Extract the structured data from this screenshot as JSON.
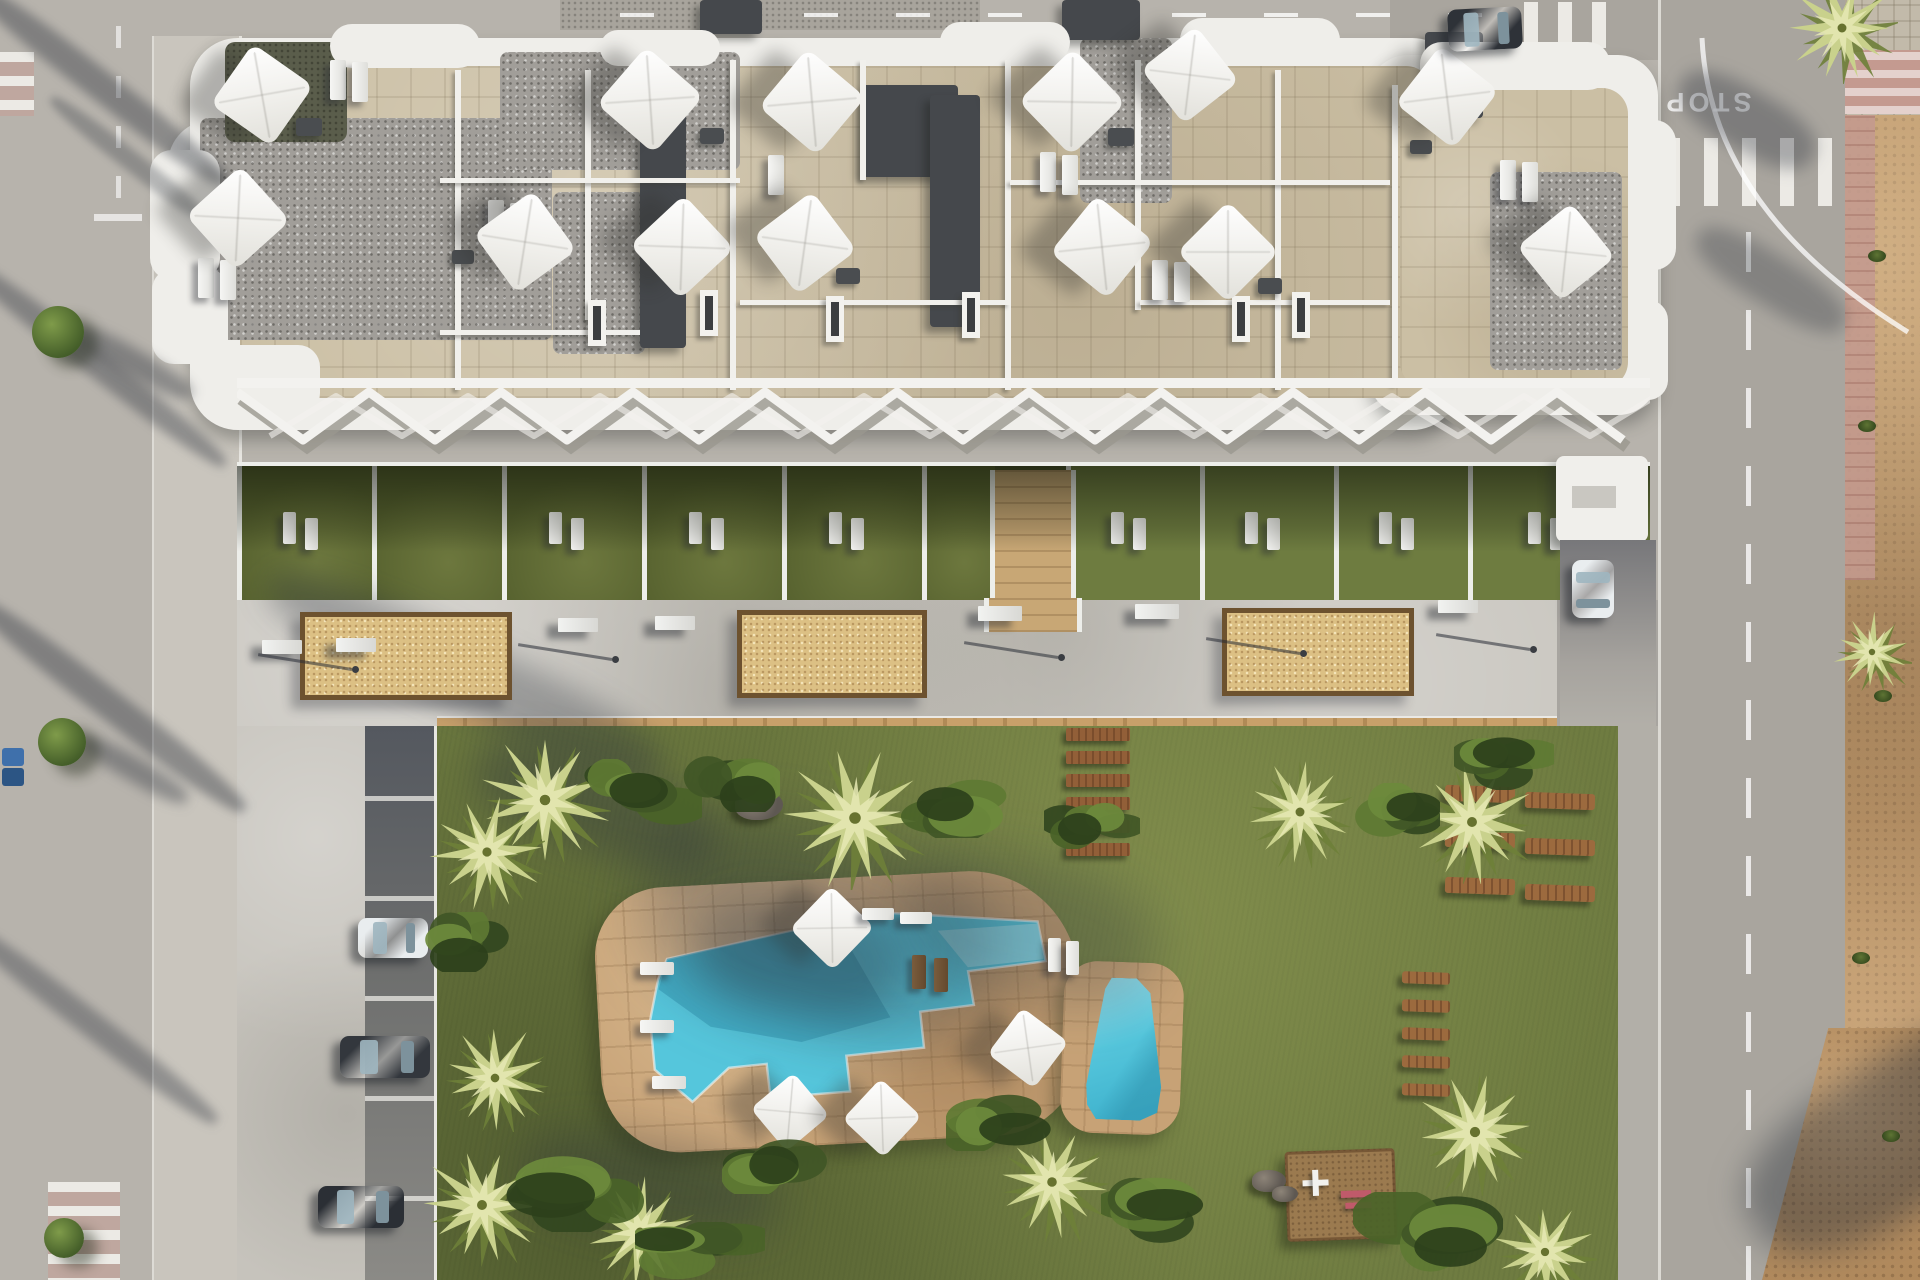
{
  "title": "aerial-render-residential-complex-with-pool",
  "road_markings": {
    "stop_text": "STOP"
  },
  "palette": {
    "road": "#b7b3ac",
    "road_right": "#a9a59e",
    "sidewalk": "#c9c5bd",
    "concrete": "#c6c3bc",
    "building_white": "#efeeea",
    "terrace_stone": "#cbbfa4",
    "gravel": "#a19e99",
    "dark_roof": "#45484c",
    "grass": "#6f7c41",
    "pool_deck_tan": "#c7a276",
    "water": "#55c6dc",
    "water_light": "#8fdcea",
    "planter_sand": "#dcc084",
    "planter_edge": "#6d522f",
    "dirt": "#b18a5d",
    "paver_pink": "#c49a90",
    "stripe_white": "#eceae5",
    "car_dark": "#2e3238",
    "car_white": "#e9edef"
  },
  "scene": {
    "roof_gravel": [
      [
        200,
        118,
        352,
        222
      ],
      [
        500,
        52,
        240,
        118
      ],
      [
        553,
        192,
        92,
        162
      ],
      [
        1080,
        38,
        92,
        165
      ],
      [
        1490,
        172,
        132,
        198
      ]
    ],
    "roof_dark": [
      [
        640,
        82,
        46,
        266
      ],
      [
        862,
        85,
        96,
        92
      ],
      [
        930,
        95,
        50,
        232
      ],
      [
        700,
        0,
        62,
        34
      ],
      [
        1062,
        0,
        78,
        40
      ],
      [
        1425,
        32,
        58,
        86
      ]
    ],
    "roof_olive": [
      [
        225,
        42,
        122,
        100
      ]
    ],
    "roof_bumps": [
      [
        330,
        24,
        150,
        44
      ],
      [
        600,
        30,
        120,
        36
      ],
      [
        940,
        22,
        130,
        40
      ],
      [
        1180,
        18,
        160,
        44
      ],
      [
        1420,
        42,
        190,
        48
      ],
      [
        150,
        150,
        70,
        130
      ],
      [
        152,
        268,
        76,
        96
      ],
      [
        1630,
        120,
        46,
        150
      ],
      [
        1628,
        300,
        40,
        100
      ],
      [
        210,
        345,
        110,
        70
      ]
    ],
    "walls_v": [
      [
        455,
        70,
        6,
        320
      ],
      [
        585,
        70,
        6,
        250
      ],
      [
        730,
        60,
        6,
        330
      ],
      [
        860,
        60,
        6,
        120
      ],
      [
        1005,
        60,
        6,
        330
      ],
      [
        1135,
        60,
        6,
        250
      ],
      [
        1275,
        70,
        6,
        320
      ],
      [
        1392,
        85,
        6,
        300
      ]
    ],
    "walls_h": [
      [
        440,
        178,
        300,
        5
      ],
      [
        740,
        300,
        270,
        5
      ],
      [
        1010,
        180,
        380,
        5
      ],
      [
        440,
        330,
        200,
        5
      ],
      [
        1140,
        300,
        250,
        5
      ]
    ],
    "skylights": [
      [
        700,
        290
      ],
      [
        826,
        296
      ],
      [
        962,
        292
      ],
      [
        1232,
        296
      ],
      [
        1292,
        292
      ],
      [
        588,
        300
      ]
    ],
    "roof_furniture": [
      [
        296,
        118,
        26,
        18
      ],
      [
        700,
        128,
        24,
        16
      ],
      [
        836,
        268,
        24,
        16
      ],
      [
        1108,
        128,
        26,
        18
      ],
      [
        1258,
        278,
        24,
        16
      ],
      [
        452,
        250,
        22,
        14
      ],
      [
        1410,
        140,
        22,
        14
      ]
    ],
    "roof_loungers": [
      [
        198,
        258
      ],
      [
        220,
        260
      ],
      [
        488,
        200
      ],
      [
        510,
        203
      ],
      [
        768,
        155
      ],
      [
        1040,
        152
      ],
      [
        1062,
        155
      ],
      [
        1152,
        260
      ],
      [
        1174,
        262
      ],
      [
        330,
        60
      ],
      [
        352,
        62
      ],
      [
        1500,
        160
      ],
      [
        1522,
        162
      ]
    ],
    "parasols": [
      [
        262,
        95,
        74
      ],
      [
        238,
        218,
        74
      ],
      [
        650,
        100,
        76
      ],
      [
        525,
        242,
        74
      ],
      [
        682,
        247,
        74
      ],
      [
        812,
        102,
        76
      ],
      [
        805,
        243,
        74
      ],
      [
        1072,
        102,
        76
      ],
      [
        1102,
        247,
        74
      ],
      [
        1190,
        75,
        70
      ],
      [
        1228,
        252,
        72
      ],
      [
        1447,
        97,
        74
      ],
      [
        1566,
        252,
        70
      ],
      [
        832,
        928,
        60
      ],
      [
        1028,
        1048,
        58
      ],
      [
        790,
        1112,
        56
      ],
      [
        882,
        1118,
        56
      ]
    ],
    "garden_cells": [
      {
        "x": 237,
        "w": 135,
        "lit": false,
        "loungers": true
      },
      {
        "x": 372,
        "w": 130,
        "lit": false,
        "loungers": false
      },
      {
        "x": 502,
        "w": 140,
        "lit": false,
        "loungers": true
      },
      {
        "x": 642,
        "w": 140,
        "lit": false,
        "loungers": true
      },
      {
        "x": 782,
        "w": 140,
        "lit": false,
        "loungers": true
      },
      {
        "x": 922,
        "w": 68,
        "lit": false,
        "loungers": false
      },
      {
        "x": 1066,
        "w": 134,
        "lit": true,
        "loungers": true
      },
      {
        "x": 1200,
        "w": 134,
        "lit": true,
        "loungers": true
      },
      {
        "x": 1334,
        "w": 134,
        "lit": true,
        "loungers": true
      },
      {
        "x": 1468,
        "w": 182,
        "lit": true,
        "loungers": true
      }
    ],
    "stone_path": {
      "x": 990,
      "y": 466,
      "w": 76,
      "h": 130
    },
    "planters": [
      [
        300,
        612,
        212,
        88
      ],
      [
        737,
        610,
        190,
        88
      ],
      [
        1222,
        608,
        192,
        88
      ]
    ],
    "benches": [
      [
        262,
        640,
        40,
        14
      ],
      [
        336,
        638,
        40,
        14
      ],
      [
        558,
        618,
        40,
        14
      ],
      [
        655,
        616,
        40,
        14
      ],
      [
        978,
        606,
        44,
        15
      ],
      [
        1135,
        604,
        44,
        15
      ],
      [
        1438,
        600,
        40,
        13
      ]
    ],
    "deck_lamps": [
      [
        352,
        668
      ],
      [
        612,
        658
      ],
      [
        1058,
        656
      ],
      [
        1300,
        652
      ],
      [
        1530,
        648
      ]
    ],
    "stall_lines_y": [
      796,
      896,
      996,
      1096,
      1196
    ],
    "planks_y": [
      728,
      751,
      774,
      797,
      820,
      843
    ],
    "wood_loungers": [
      [
        1445,
        786,
        70,
        16
      ],
      [
        1445,
        832,
        70,
        16
      ],
      [
        1445,
        878,
        70,
        16
      ],
      [
        1525,
        793,
        70,
        16
      ],
      [
        1525,
        839,
        70,
        16
      ],
      [
        1525,
        885,
        70,
        16
      ],
      [
        1402,
        972,
        48,
        12
      ],
      [
        1402,
        1000,
        48,
        12
      ],
      [
        1402,
        1028,
        48,
        12
      ],
      [
        1402,
        1056,
        48,
        12
      ],
      [
        1402,
        1084,
        48,
        12
      ]
    ],
    "pool_loungers_white": [
      [
        640,
        962,
        34,
        13
      ],
      [
        640,
        1020,
        34,
        13
      ],
      [
        652,
        1076,
        34,
        13
      ],
      [
        1048,
        938,
        13,
        34
      ],
      [
        1066,
        941,
        13,
        34
      ],
      [
        862,
        908,
        32,
        12
      ],
      [
        900,
        912,
        32,
        12
      ]
    ],
    "pool_loungers_dark": [
      [
        912,
        955,
        14,
        34
      ],
      [
        934,
        958,
        14,
        34
      ]
    ],
    "pool_water": [
      [
        72,
        72
      ],
      [
        282,
        36
      ],
      [
        444,
        54
      ],
      [
        450,
        94
      ],
      [
        372,
        100
      ],
      [
        376,
        134
      ],
      [
        322,
        138
      ],
      [
        324,
        174
      ],
      [
        246,
        178
      ],
      [
        248,
        214
      ],
      [
        168,
        216
      ],
      [
        166,
        182
      ],
      [
        128,
        184
      ],
      [
        90,
        216
      ],
      [
        54,
        182
      ],
      [
        52,
        132
      ],
      [
        62,
        92
      ]
    ],
    "pool_water_light": [
      [
        344,
        58
      ],
      [
        444,
        56
      ],
      [
        448,
        92
      ],
      [
        372,
        96
      ]
    ],
    "pool_water_shadow": [
      [
        72,
        72
      ],
      [
        242,
        44
      ],
      [
        292,
        142
      ],
      [
        202,
        162
      ],
      [
        112,
        142
      ],
      [
        62,
        102
      ]
    ],
    "palms": [
      [
        545,
        800,
        66
      ],
      [
        855,
        818,
        72
      ],
      [
        1300,
        812,
        56
      ],
      [
        1472,
        822,
        62
      ],
      [
        487,
        852,
        58
      ],
      [
        495,
        1078,
        54
      ],
      [
        482,
        1205,
        62
      ],
      [
        640,
        1232,
        56
      ],
      [
        1052,
        1182,
        60
      ],
      [
        1475,
        1132,
        64
      ],
      [
        1545,
        1252,
        52
      ],
      [
        1842,
        28,
        56
      ],
      [
        1872,
        652,
        40
      ]
    ],
    "bushes": [
      [
        642,
        792,
        120,
        66
      ],
      [
        728,
        782,
        104,
        60
      ],
      [
        952,
        806,
        140,
        64
      ],
      [
        1092,
        822,
        96,
        54
      ],
      [
        1386,
        812,
        108,
        58
      ],
      [
        470,
        942,
        92,
        60
      ],
      [
        580,
        1192,
        150,
        80
      ],
      [
        782,
        1162,
        120,
        64
      ],
      [
        1002,
        1120,
        112,
        62
      ],
      [
        1166,
        1212,
        130,
        72
      ],
      [
        1428,
        1232,
        150,
        80
      ],
      [
        1504,
        762,
        100,
        56
      ],
      [
        700,
        1252,
        130,
        60
      ]
    ],
    "rocks": [
      [
        735,
        790,
        48,
        30
      ],
      [
        1252,
        1170,
        34,
        22
      ],
      [
        1272,
        1186,
        26,
        16
      ]
    ],
    "trees_left": [
      [
        58,
        332,
        26
      ],
      [
        62,
        742,
        24
      ],
      [
        64,
        1238,
        20
      ]
    ],
    "weeds": [
      [
        1858,
        420
      ],
      [
        1874,
        690
      ],
      [
        1852,
        952
      ],
      [
        1882,
        1130
      ],
      [
        1868,
        250
      ]
    ],
    "bins": [
      [
        2,
        748,
        "#3f70ab"
      ],
      [
        2,
        768,
        "#2c5584"
      ]
    ],
    "cars": [
      {
        "x": 1448,
        "y": 8,
        "w": 74,
        "h": 42,
        "body": "#2e3238",
        "rot": -3,
        "name": "car-dark-street"
      },
      {
        "x": 1572,
        "y": 560,
        "w": 42,
        "h": 58,
        "body": "#e9edef",
        "rot": 0,
        "name": "car-white-ramp"
      },
      {
        "x": 358,
        "y": 918,
        "w": 70,
        "h": 40,
        "body": "#e9edef",
        "rot": 0,
        "name": "car-white-parking"
      },
      {
        "x": 340,
        "y": 1036,
        "w": 90,
        "h": 42,
        "body": "#33373d",
        "rot": 0,
        "name": "car-dark-parking"
      },
      {
        "x": 318,
        "y": 1186,
        "w": 86,
        "h": 42,
        "body": "#2b2f35",
        "rot": 0,
        "name": "car-dark-parking-2"
      }
    ],
    "shadow_streaks": [
      [
        -60,
        70,
        320,
        30,
        38,
        0.4,
        5
      ],
      [
        -70,
        350,
        330,
        26,
        38,
        0.38,
        5
      ],
      [
        -60,
        690,
        340,
        30,
        38,
        0.4,
        5
      ],
      [
        -70,
        1010,
        320,
        26,
        38,
        0.36,
        5
      ],
      [
        30,
        150,
        200,
        20,
        38,
        0.3,
        4
      ],
      [
        70,
        350,
        130,
        26,
        30,
        0.4,
        6
      ],
      [
        75,
        758,
        120,
        24,
        30,
        0.38,
        6
      ],
      [
        250,
        640,
        430,
        70,
        25,
        0.32,
        14
      ],
      [
        640,
        830,
        360,
        200,
        15,
        0.3,
        30
      ],
      [
        470,
        760,
        250,
        90,
        20,
        0.35,
        18
      ],
      [
        900,
        860,
        260,
        140,
        12,
        0.25,
        26
      ],
      [
        700,
        900,
        200,
        110,
        10,
        0.28,
        20
      ],
      [
        520,
        1140,
        260,
        90,
        10,
        0.3,
        22
      ],
      [
        1672,
        90,
        150,
        60,
        30,
        0.35,
        8
      ],
      [
        1686,
        255,
        170,
        50,
        32,
        0.3,
        8
      ],
      [
        1730,
        1060,
        340,
        150,
        -32,
        0.42,
        16
      ]
    ],
    "playground_white": [
      [
        14,
        26,
        26,
        6
      ],
      [
        24,
        16,
        6,
        26
      ]
    ],
    "playground_pink": [
      [
        52,
        38,
        30,
        7
      ],
      [
        56,
        50,
        26,
        6
      ]
    ]
  }
}
